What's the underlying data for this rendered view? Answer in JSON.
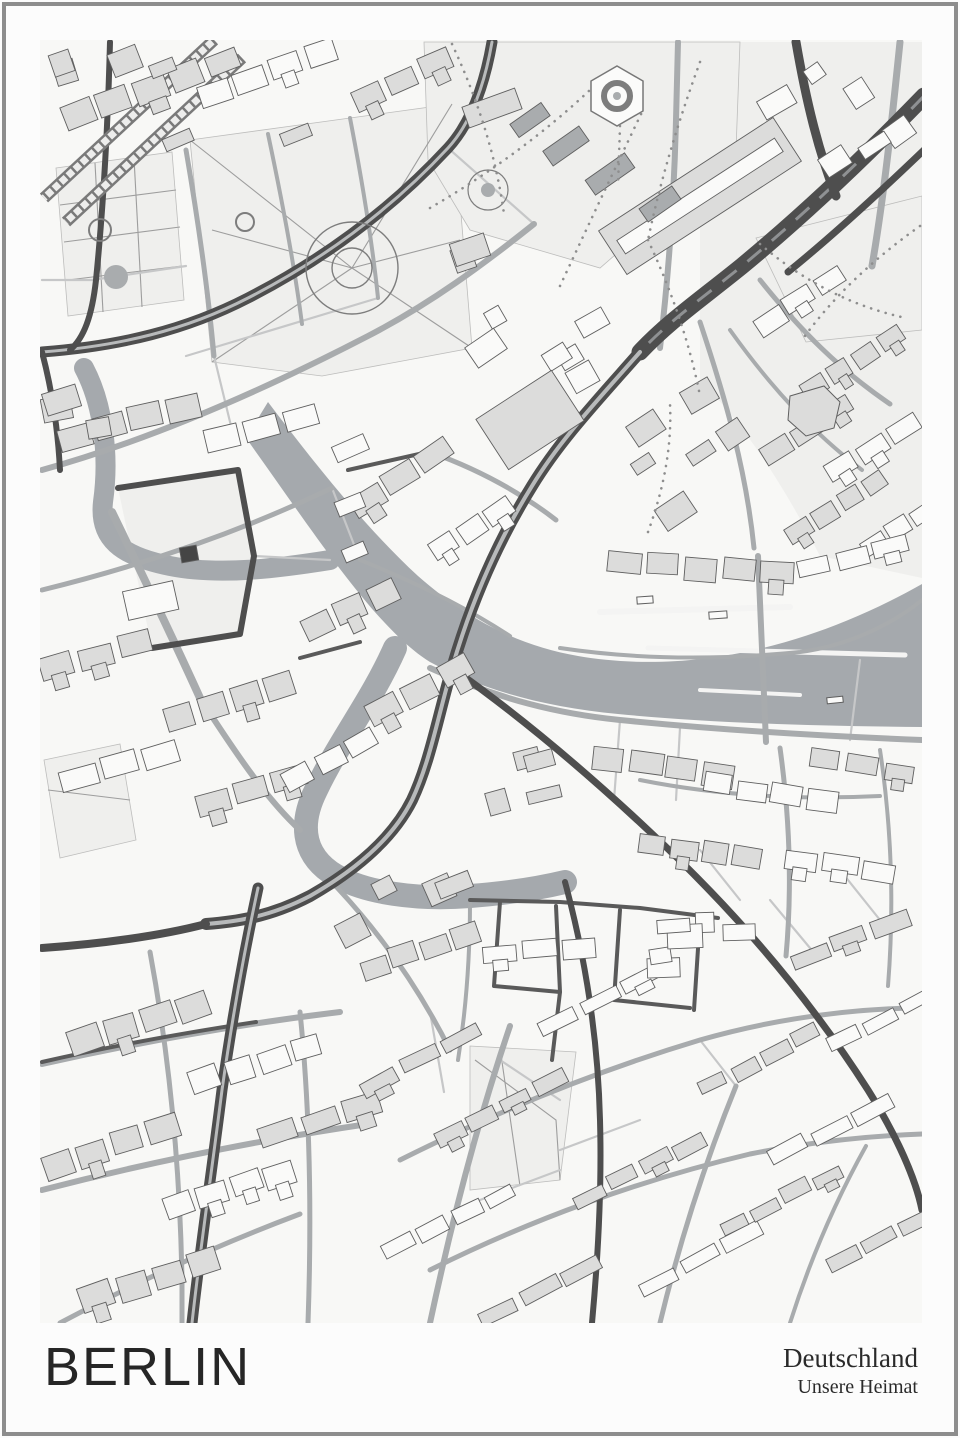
{
  "poster": {
    "title": "BERLIN",
    "subtitle_line1": "Deutschland",
    "subtitle_line2": "Unsere Heimat",
    "frame_color": "#8d8d8d",
    "background": "#fcfcfc",
    "title_color": "#262626"
  },
  "map": {
    "bounds": {
      "x": 40,
      "y": 40,
      "w": 882,
      "h": 1283
    },
    "colors": {
      "bg": "#f8f8f6",
      "tint": "#ececeb",
      "park": "#efefed",
      "water": "#a5a9ad",
      "wake": "#f4f4f3",
      "building_gray": "#dcdcdb",
      "building_white": "#fafaf9",
      "building_dark": "#a9acae",
      "building_stroke": "#5f5f5f",
      "road_major": "#4e4e4e",
      "road_major_core": "#b8babb",
      "road_medium": "#a8abad",
      "road_minor": "#c6c7c8",
      "road_dark_local": "#5a5a5a",
      "rail": "#7a7a7a",
      "rail_core": "#ededec",
      "thin_path": "#9d9d9d",
      "dotted_path": "#8e8e8e"
    },
    "tints": [
      {
        "d": "M 700,42 L 922,42 L 922,578 L 820,556 C 780,478 740,420 700,380 Z"
      },
      {
        "d": "M 118,488 L 238,470 L 254,556 L 240,634 L 152,648 Z"
      }
    ],
    "parks": [
      {
        "d": "M 56,168 L 172,152 L 184,300 L 68,316 Z"
      },
      {
        "d": "M 190,140 L 452,104 L 472,348 L 322,376 L 212,362 Z"
      },
      {
        "d": "M 424,42 L 740,42 L 736,150 L 600,268 L 470,230 L 428,160 Z"
      },
      {
        "d": "M 756,238 L 922,196 L 922,330 L 806,342 Z"
      },
      {
        "d": "M 470,1046 L 576,1052 L 560,1180 L 470,1190 Z"
      },
      {
        "d": "M 44,760 L 120,744 L 136,840 L 60,858 Z"
      }
    ],
    "water": {
      "river": "M 268,402 C 318,468 368,530 418,576 C 468,620 520,646 578,656 C 660,670 780,664 922,584 L 922,727 C 800,726 700,722 618,714 C 545,707 482,690 430,662 C 375,628 312,530 246,438 Z",
      "strokes": [
        {
          "d": "M 84,368 C 102,402 110,452 103,502 C 99,538 120,556 170,566 C 220,576 280,568 330,560",
          "w": 20
        },
        {
          "d": "M 395,648 C 372,700 340,740 316,790 C 300,822 302,852 330,872 C 362,894 420,900 470,896 C 510,893 540,888 565,882",
          "w": 24
        }
      ],
      "wakes": [
        {
          "x1": 600,
          "y1": 612,
          "x2": 790,
          "y2": 607,
          "w": 6
        },
        {
          "x1": 648,
          "y1": 648,
          "x2": 905,
          "y2": 655,
          "w": 5
        },
        {
          "x1": 700,
          "y1": 690,
          "x2": 800,
          "y2": 695,
          "w": 4
        }
      ],
      "boats": [
        [
          645,
          600,
          16,
          7,
          -4
        ],
        [
          718,
          615,
          18,
          7,
          -4
        ],
        [
          835,
          700,
          16,
          6,
          -6
        ]
      ]
    },
    "rail": [
      {
        "d": "M 214,40 L 44,198"
      },
      {
        "d": "M 242,58 L 66,222"
      }
    ],
    "roads_major": [
      {
        "d": "M 924,96 C 862,160 800,218 742,266 C 700,300 668,322 640,352",
        "w": 17,
        "style": "braided"
      },
      {
        "d": "M 640,352 C 596,402 560,440 532,486 C 496,544 470,606 452,668 C 438,716 430,762 412,800 C 392,840 352,872 310,896 C 268,918 232,922 206,924",
        "w": 12,
        "style": "double"
      },
      {
        "d": "M 258,888 C 244,952 232,1020 222,1090 C 212,1170 200,1250 192,1323",
        "w": 11,
        "style": "double"
      },
      {
        "d": "M 206,924 C 160,936 100,944 42,948",
        "w": 8,
        "style": "solid"
      },
      {
        "d": "M 796,42 C 806,100 818,150 836,196",
        "w": 9,
        "style": "solid"
      },
      {
        "d": "M 924,150 C 876,196 830,238 788,272",
        "w": 7,
        "style": "solid"
      },
      {
        "d": "M 42,352 C 120,346 186,330 248,298 C 330,256 396,204 448,148 C 470,124 484,88 492,42",
        "w": 11,
        "style": "double"
      },
      {
        "d": "M 42,352 C 52,390 58,430 60,470",
        "w": 6,
        "style": "solid"
      },
      {
        "d": "M 110,42 C 108,120 104,200 96,280 C 92,316 84,338 70,350",
        "w": 6,
        "style": "solid"
      },
      {
        "d": "M 118,488 L 238,470 L 254,556 L 240,634 L 152,648",
        "w": 6,
        "style": "solid"
      },
      {
        "d": "M 452,668 C 520,716 584,770 648,830 C 732,908 808,996 868,1090 C 898,1138 916,1180 922,1210",
        "w": 7,
        "style": "solid"
      },
      {
        "d": "M 565,882 C 586,960 598,1040 600,1120 C 602,1190 598,1258 592,1323",
        "w": 6,
        "style": "solid"
      }
    ],
    "roads_dark_local": [
      {
        "d": "M 470,900 L 560,902 L 640,908 L 718,918"
      },
      {
        "d": "M 500,902 L 494,986 L 560,992 L 556,906"
      },
      {
        "d": "M 620,910 L 614,1000 L 690,1008"
      },
      {
        "d": "M 700,918 L 694,1010"
      },
      {
        "d": "M 560,992 L 552,1060"
      },
      {
        "d": "M 348,470 L 428,452"
      },
      {
        "d": "M 300,658 L 360,642"
      },
      {
        "d": "M 42,1062 C 120,1044 190,1032 256,1022"
      }
    ],
    "roads_medium": [
      {
        "d": "M 42,470 C 150,440 260,392 368,336 C 430,304 484,264 534,224",
        "w": 6
      },
      {
        "d": "M 42,590 C 140,566 240,532 332,488",
        "w": 5
      },
      {
        "d": "M 186,150 C 198,220 208,290 214,356",
        "w": 5
      },
      {
        "d": "M 268,134 C 282,200 294,262 302,324",
        "w": 4
      },
      {
        "d": "M 350,118 C 362,180 372,240 378,298",
        "w": 4
      },
      {
        "d": "M 660,348 C 668,280 674,200 676,120 L 678,42",
        "w": 6
      },
      {
        "d": "M 700,322 C 726,400 746,470 754,548",
        "w": 5
      },
      {
        "d": "M 430,668 C 500,700 560,714 620,720 C 720,730 820,736 922,740",
        "w": 6
      },
      {
        "d": "M 560,648 C 640,660 720,660 800,652 C 846,646 890,626 922,600",
        "w": 4
      },
      {
        "d": "M 758,556 L 766,742",
        "w": 6
      },
      {
        "d": "M 112,512 C 142,574 172,636 200,698",
        "w": 8
      },
      {
        "d": "M 200,698 C 240,760 268,800 300,830",
        "w": 6
      },
      {
        "d": "M 42,1064 C 140,1042 240,1024 340,1012",
        "w": 6
      },
      {
        "d": "M 42,1190 C 150,1162 260,1140 368,1124",
        "w": 6
      },
      {
        "d": "M 60,1323 C 140,1280 220,1244 300,1214",
        "w": 5
      },
      {
        "d": "M 150,952 C 170,1060 180,1170 182,1280 L 182,1323",
        "w": 5
      },
      {
        "d": "M 300,1012 C 310,1110 312,1210 308,1323",
        "w": 5
      },
      {
        "d": "M 430,1323 C 452,1220 478,1120 510,1026",
        "w": 6
      },
      {
        "d": "M 660,1323 C 680,1240 706,1160 736,1086",
        "w": 5
      },
      {
        "d": "M 790,1323 C 810,1260 836,1200 866,1146",
        "w": 4
      },
      {
        "d": "M 400,1160 C 500,1110 600,1070 700,1040 C 770,1020 840,1010 910,1008",
        "w": 5
      },
      {
        "d": "M 430,1270 C 530,1220 640,1180 750,1154 C 810,1142 870,1136 922,1134",
        "w": 5
      },
      {
        "d": "M 640,780 C 720,796 800,800 880,796",
        "w": 4
      },
      {
        "d": "M 780,748 C 790,820 792,890 786,956",
        "w": 5
      },
      {
        "d": "M 880,750 C 892,830 894,910 888,986",
        "w": 4
      },
      {
        "d": "M 900,42 C 892,120 884,196 872,266",
        "w": 7
      },
      {
        "d": "M 760,280 C 800,330 840,370 890,404",
        "w": 5
      },
      {
        "d": "M 730,330 C 770,386 812,432 862,470",
        "w": 4
      },
      {
        "d": "M 430,452 C 480,470 520,492 556,520",
        "w": 5
      },
      {
        "d": "M 360,560 C 420,584 470,610 510,636",
        "w": 4
      },
      {
        "d": "M 330,880 C 380,932 420,990 450,1050",
        "w": 5
      },
      {
        "d": "M 470,902 C 470,960 466,1010 458,1060",
        "w": 4
      }
    ],
    "roads_minor": [
      {
        "d": "M 186,356 L 378,298"
      },
      {
        "d": "M 214,356 L 232,430"
      },
      {
        "d": "M 92,280 L 186,266"
      },
      {
        "d": "M 42,280 L 92,280"
      },
      {
        "d": "M 448,148 L 534,224"
      },
      {
        "d": "M 620,720 L 614,800"
      },
      {
        "d": "M 680,728 L 676,800"
      },
      {
        "d": "M 860,660 L 850,740"
      },
      {
        "d": "M 332,488 L 360,560"
      },
      {
        "d": "M 254,556 L 330,560"
      },
      {
        "d": "M 430,1012 L 444,1092"
      },
      {
        "d": "M 700,1040 L 736,1086"
      },
      {
        "d": "M 770,900 L 820,960"
      },
      {
        "d": "M 700,850 L 740,900"
      },
      {
        "d": "M 840,870 L 880,920"
      },
      {
        "d": "M 560,1150 L 640,1120"
      },
      {
        "d": "M 480,1200 L 560,1170"
      },
      {
        "d": "M 500,1060 L 560,1100"
      }
    ],
    "thin_paths": [
      {
        "d": "M 60,205 L 176,190"
      },
      {
        "d": "M 64,242 L 180,227"
      },
      {
        "d": "M 68,280 L 182,266"
      },
      {
        "d": "M 95,163 L 103,312"
      },
      {
        "d": "M 134,158 L 142,307"
      },
      {
        "d": "M 352,268 L 212,362"
      },
      {
        "d": "M 352,268 L 472,348"
      },
      {
        "d": "M 352,268 L 452,104"
      },
      {
        "d": "M 352,268 L 190,140"
      },
      {
        "d": "M 352,268 L 212,230"
      },
      {
        "d": "M 352,268 L 460,240"
      },
      {
        "d": "M 475,1060 L 556,1120 L 560,1180"
      },
      {
        "d": "M 500,1048 L 520,1186"
      },
      {
        "d": "M 48,790 L 130,800"
      }
    ],
    "rings": [
      {
        "cx": 100,
        "cy": 230,
        "r": 11,
        "w": 2
      },
      {
        "cx": 245,
        "cy": 222,
        "r": 9,
        "w": 2
      },
      {
        "cx": 352,
        "cy": 268,
        "r": 46,
        "w": 1.4
      },
      {
        "cx": 352,
        "cy": 268,
        "r": 20,
        "w": 1.4
      },
      {
        "cx": 617,
        "cy": 96,
        "r": 13,
        "w": 6
      },
      {
        "cx": 488,
        "cy": 190,
        "r": 20,
        "w": 1.2
      }
    ],
    "dots": [
      {
        "cx": 116,
        "cy": 277,
        "r": 12
      },
      {
        "cx": 488,
        "cy": 190,
        "r": 7
      },
      {
        "cx": 617,
        "cy": 96,
        "r": 4
      }
    ],
    "pond_hex": "M 617,66 L 643,81 L 643,111 L 617,126 L 591,111 L 591,81 Z",
    "dotted_paths": [
      {
        "d": "M 430,208 C 492,172 548,130 592,88"
      },
      {
        "d": "M 452,44 C 478,100 496,156 504,214"
      },
      {
        "d": "M 560,286 C 588,226 616,166 644,108"
      },
      {
        "d": "M 620,126 L 618,186"
      },
      {
        "d": "M 700,62 C 678,122 660,182 648,240"
      },
      {
        "d": "M 760,244 C 802,280 850,306 906,318"
      },
      {
        "d": "M 920,226 C 872,260 832,298 802,340"
      },
      {
        "d": "M 648,240 C 672,292 690,344 700,396"
      },
      {
        "d": "M 648,532 C 664,488 672,446 670,404"
      }
    ],
    "special_buildings": [
      {
        "type": "rrect",
        "cx": 700,
        "cy": 196,
        "w": 208,
        "h": 52,
        "a": -33,
        "fill": "gray"
      },
      {
        "type": "rrect",
        "cx": 700,
        "cy": 196,
        "w": 188,
        "h": 16,
        "a": -33,
        "fill": "white"
      },
      {
        "type": "rrect",
        "cx": 189,
        "cy": 554,
        "w": 17,
        "h": 15,
        "a": -10,
        "fill": "dark2"
      },
      {
        "type": "path",
        "d": "M 790,396 L 824,386 L 840,402 L 834,428 L 806,436 L 788,420 Z",
        "fill": "gray"
      },
      {
        "type": "rrect",
        "cx": 530,
        "cy": 420,
        "w": 90,
        "h": 60,
        "a": -33,
        "fill": "gray"
      },
      {
        "type": "rrect",
        "cx": 492,
        "cy": 108,
        "w": 56,
        "h": 22,
        "a": -20,
        "fill": "gray"
      },
      {
        "type": "rrect",
        "cx": 530,
        "cy": 120,
        "w": 38,
        "h": 16,
        "a": -35,
        "fill": "dark"
      },
      {
        "type": "rrect",
        "cx": 566,
        "cy": 146,
        "w": 44,
        "h": 18,
        "a": -35,
        "fill": "dark"
      },
      {
        "type": "rrect",
        "cx": 610,
        "cy": 174,
        "w": 48,
        "h": 18,
        "a": -35,
        "fill": "dark"
      },
      {
        "type": "rrect",
        "cx": 660,
        "cy": 204,
        "w": 40,
        "h": 16,
        "a": -35,
        "fill": "dark"
      }
    ],
    "strips": [
      [
        132,
        96,
        150,
        26,
        -20,
        4,
        "g"
      ],
      [
        268,
        72,
        150,
        24,
        -20,
        4,
        "w"
      ],
      [
        402,
        80,
        110,
        22,
        -25,
        3,
        "g"
      ],
      [
        800,
        300,
        110,
        20,
        -33,
        3,
        "w"
      ],
      [
        852,
        362,
        120,
        20,
        -33,
        4,
        "g"
      ],
      [
        806,
        430,
        110,
        20,
        -33,
        3,
        "g"
      ],
      [
        872,
        448,
        110,
        20,
        -33,
        3,
        "w"
      ],
      [
        838,
        508,
        120,
        20,
        -33,
        4,
        "g"
      ],
      [
        898,
        528,
        90,
        18,
        -33,
        3,
        "w"
      ],
      [
        128,
        422,
        150,
        26,
        -14,
        4,
        "g"
      ],
      [
        262,
        430,
        120,
        24,
        -14,
        3,
        "w"
      ],
      [
        152,
        600,
        60,
        30,
        -12,
        1,
        "w"
      ],
      [
        96,
        656,
        120,
        24,
        -16,
        3,
        "g"
      ],
      [
        230,
        700,
        140,
        26,
        -16,
        4,
        "g"
      ],
      [
        120,
        766,
        130,
        24,
        -16,
        3,
        "w"
      ],
      [
        250,
        790,
        120,
        22,
        -16,
        3,
        "g"
      ],
      [
        400,
        478,
        120,
        24,
        -33,
        3,
        "g"
      ],
      [
        472,
        530,
        100,
        22,
        -33,
        3,
        "w"
      ],
      [
        350,
        610,
        110,
        24,
        -25,
        3,
        "g"
      ],
      [
        420,
        690,
        120,
        24,
        -28,
        3,
        "g"
      ],
      [
        330,
        760,
        110,
        22,
        -28,
        3,
        "w"
      ],
      [
        664,
        766,
        150,
        24,
        8,
        4,
        "g"
      ],
      [
        770,
        792,
        140,
        22,
        8,
        4,
        "w"
      ],
      [
        862,
        766,
        110,
        20,
        8,
        3,
        "g"
      ],
      [
        700,
        850,
        130,
        22,
        8,
        4,
        "g"
      ],
      [
        840,
        866,
        120,
        20,
        8,
        3,
        "w"
      ],
      [
        700,
        568,
        190,
        24,
        4,
        5,
        "g"
      ],
      [
        852,
        556,
        120,
        20,
        -14,
        3,
        "w"
      ],
      [
        420,
        950,
        130,
        22,
        -20,
        4,
        "g"
      ],
      [
        540,
        950,
        120,
        20,
        -5,
        3,
        "w"
      ],
      [
        140,
        1022,
        150,
        26,
        -18,
        4,
        "g"
      ],
      [
        256,
        1064,
        140,
        24,
        -18,
        4,
        "w"
      ],
      [
        110,
        1146,
        150,
        26,
        -18,
        4,
        "g"
      ],
      [
        230,
        1190,
        140,
        24,
        -18,
        4,
        "w"
      ],
      [
        150,
        1280,
        150,
        26,
        -18,
        4,
        "g"
      ],
      [
        320,
        1120,
        130,
        22,
        -18,
        3,
        "g"
      ],
      [
        420,
        1060,
        140,
        16,
        -27,
        3,
        "g"
      ],
      [
        500,
        1110,
        150,
        16,
        -27,
        4,
        "g"
      ],
      [
        450,
        1220,
        150,
        16,
        -27,
        4,
        "w"
      ],
      [
        540,
        1290,
        140,
        16,
        -27,
        3,
        "g"
      ],
      [
        600,
        1000,
        140,
        16,
        -27,
        3,
        "w"
      ],
      [
        640,
        1170,
        150,
        16,
        -27,
        4,
        "g"
      ],
      [
        700,
        1260,
        140,
        16,
        -27,
        3,
        "w"
      ],
      [
        760,
        1060,
        140,
        16,
        -27,
        4,
        "g"
      ],
      [
        830,
        1130,
        140,
        16,
        -27,
        3,
        "w"
      ],
      [
        780,
        1200,
        140,
        16,
        -27,
        4,
        "g"
      ],
      [
        880,
        1240,
        120,
        16,
        -27,
        3,
        "g"
      ],
      [
        880,
        1020,
        120,
        16,
        -27,
        3,
        "w"
      ],
      [
        850,
        940,
        130,
        18,
        -20,
        3,
        "g"
      ]
    ],
    "scatter_zones": [
      [
        56,
        56,
        300,
        140,
        8,
        -20,
        "g"
      ],
      [
        480,
        280,
        600,
        420,
        6,
        -33,
        "w"
      ],
      [
        620,
        380,
        740,
        520,
        6,
        -33,
        "g"
      ],
      [
        56,
        380,
        110,
        470,
        3,
        -14,
        "g"
      ],
      [
        300,
        440,
        360,
        560,
        3,
        -25,
        "w"
      ],
      [
        580,
        900,
        740,
        1010,
        6,
        -5,
        "w"
      ],
      [
        350,
        860,
        460,
        940,
        4,
        -25,
        "g"
      ],
      [
        460,
        740,
        560,
        830,
        4,
        -15,
        "g"
      ],
      [
        746,
        42,
        920,
        190,
        6,
        -33,
        "w"
      ],
      [
        420,
        240,
        470,
        330,
        2,
        -20,
        "g"
      ]
    ]
  }
}
